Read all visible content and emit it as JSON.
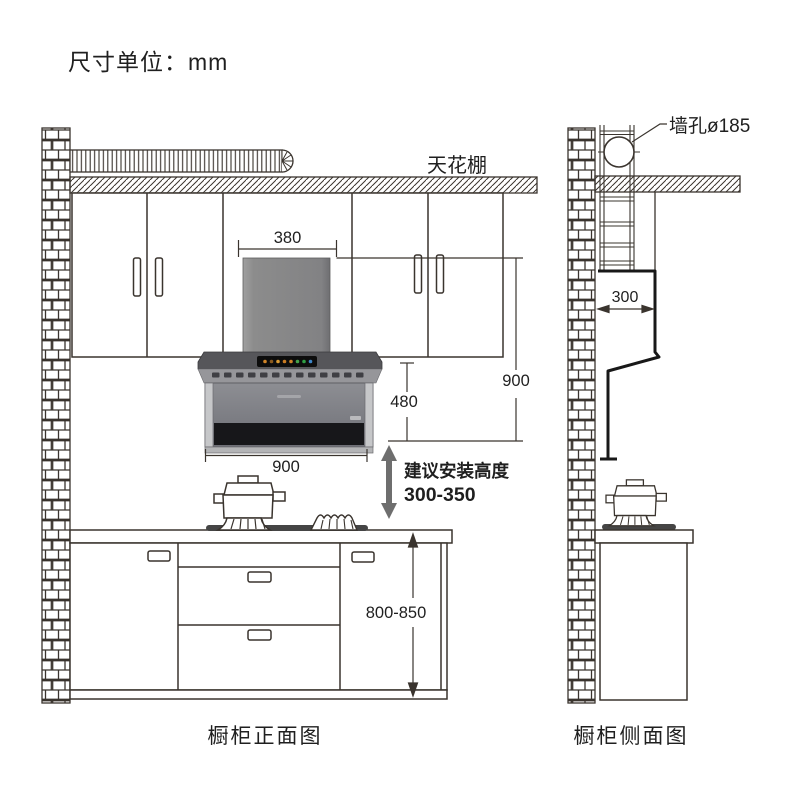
{
  "unit_label": "尺寸单位：mm",
  "front_view": {
    "caption": "橱柜正面图",
    "ceiling_label": "天花棚",
    "dim_chimney_width": "380",
    "dim_hood_total_height": "900",
    "dim_hood_body_height": "480",
    "dim_hood_width": "900",
    "dim_counter_height": "800-850",
    "install_title": "建议安装高度",
    "install_range": "300-350"
  },
  "side_view": {
    "caption": "橱柜侧面图",
    "wall_hole_label": "墙孔ø185",
    "dim_hood_depth": "300"
  },
  "colors": {
    "line": "#3a342e",
    "text": "#1f1f1f",
    "hood_gray": "#85868b",
    "hood_dark_gray": "#56565a",
    "panel_black": "#0d0d0d",
    "silver": "#c6c7c9",
    "arrow_gray": "#6e6e6e",
    "indicator_amber": "#cf8428",
    "indicator_green": "#44a24a",
    "indicator_blue": "#3e86c8"
  }
}
